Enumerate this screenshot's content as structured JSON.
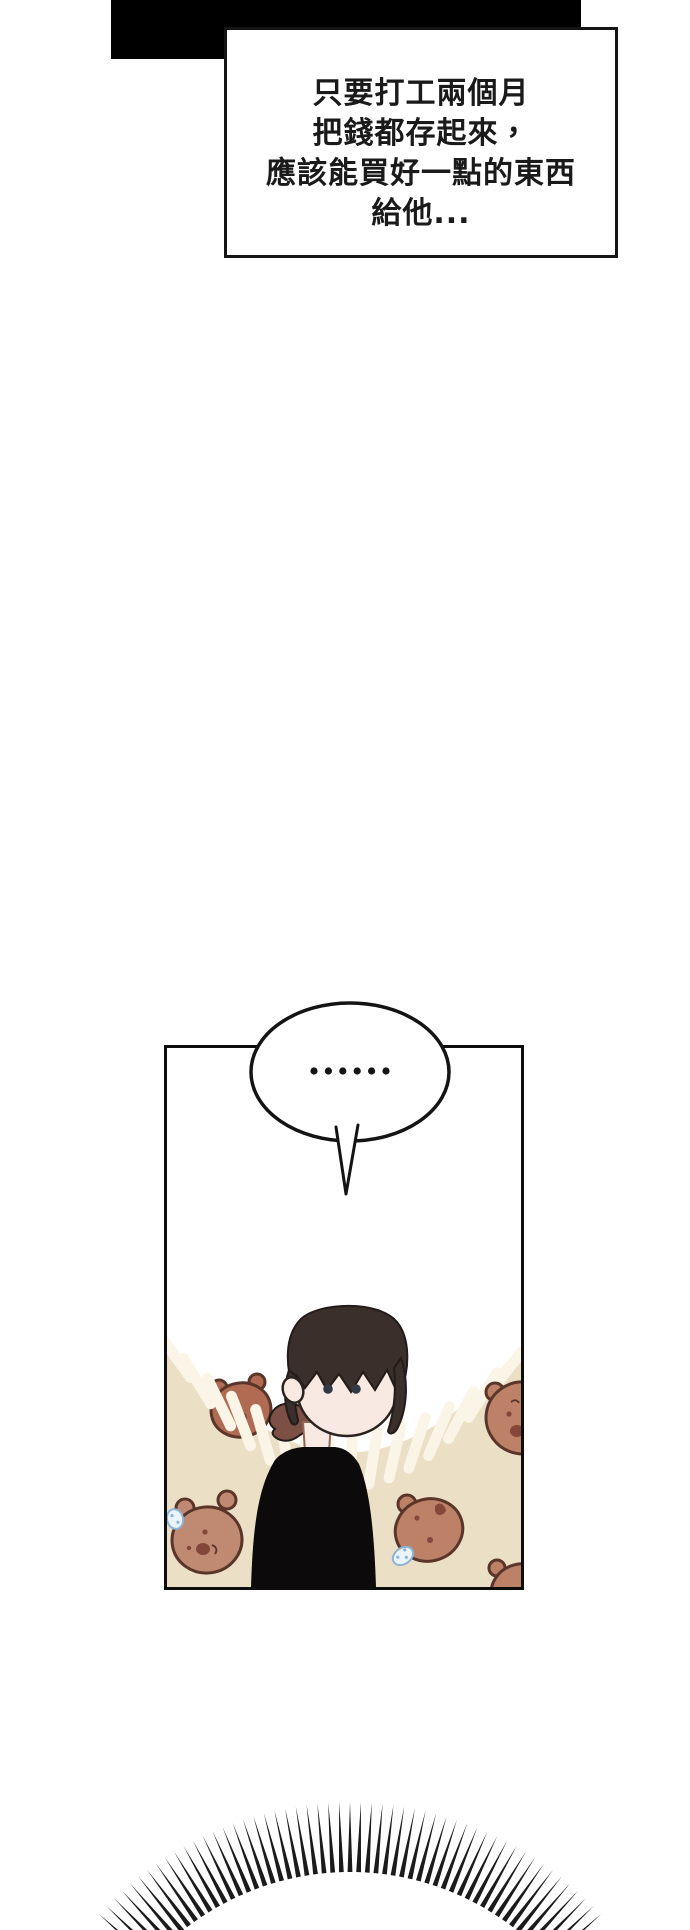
{
  "page": {
    "background": "#ffffff",
    "width": 690,
    "height": 1930
  },
  "narration": {
    "lines": [
      "只要打工兩個月",
      "把錢都存起來，",
      "應該能買好一點的東西",
      "給他..."
    ],
    "text_color": "#1a1a1a",
    "border_color": "#141414",
    "box_bg": "#ffffff"
  },
  "speech_bubble": {
    "text": "……",
    "fill": "#ffffff",
    "outline": "#141414"
  },
  "art": {
    "colors": {
      "beige": "#ebdfc5",
      "stripe": "#fbf5e8",
      "bear_fill": "#c08a72",
      "bear_fill_warm": "#bd8168",
      "bear_fill_dark": "#b06b52",
      "bear_outline": "#5a3529",
      "bear_detail": "#84473a",
      "sprout_fill": "#eaf4fa",
      "sprout_outline": "#8cb4d8",
      "skin": "#f8eae2",
      "neck_shadow": "#8d685a",
      "hair": "#3a2f2b",
      "hair_outline": "#231b19",
      "ponytail": "#7c5045",
      "sweater": "#0c0a0a",
      "face_outline": "#2b2320",
      "eye": "#333a45",
      "panel_border": "#0d0d0d",
      "burst": "#1b1b1b",
      "banner": "#000000"
    },
    "bubble_dots": {
      "count": 6,
      "start_x": 314,
      "spacing": 14.4,
      "y": 1071,
      "radius": 3.6,
      "color": "#141414"
    },
    "burst": {
      "cx": 350,
      "cy": 2140,
      "inner_r": 268,
      "outer_r": 338,
      "count": 53,
      "start_deg": -138,
      "end_deg": -42,
      "base_half_width": 2.4,
      "color": "#1b1b1b"
    }
  }
}
